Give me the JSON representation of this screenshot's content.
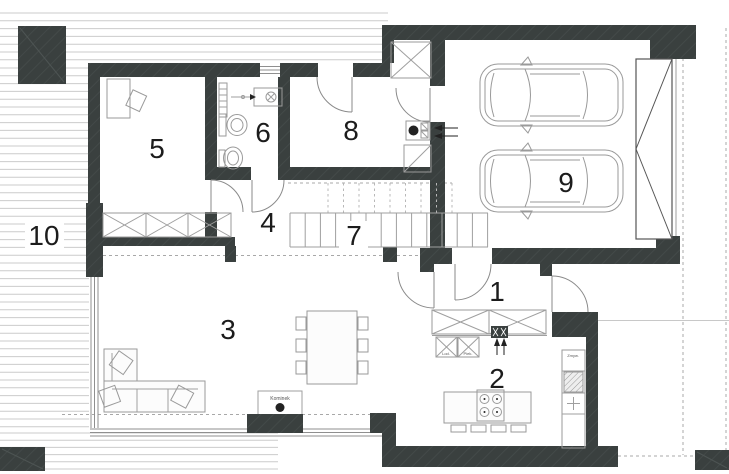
{
  "rooms": [
    {
      "number": "1"
    },
    {
      "number": "2"
    },
    {
      "number": "3"
    },
    {
      "number": "4"
    },
    {
      "number": "5"
    },
    {
      "number": "6"
    },
    {
      "number": "7"
    },
    {
      "number": "8"
    },
    {
      "number": "9"
    },
    {
      "number": "10"
    }
  ],
  "labels": {
    "fireplace": "Kominek",
    "dishwasher": "Zmyw.",
    "fridge": "Lod.",
    "oven": "Piek."
  },
  "colors": {
    "wall": "#3a403f",
    "furniture_line": "#9a9a9a",
    "deck_line": "#cbcbcb",
    "dash_line": "#a8a8a8",
    "number_text": "#1c1c1c",
    "label_text": "#555555"
  }
}
